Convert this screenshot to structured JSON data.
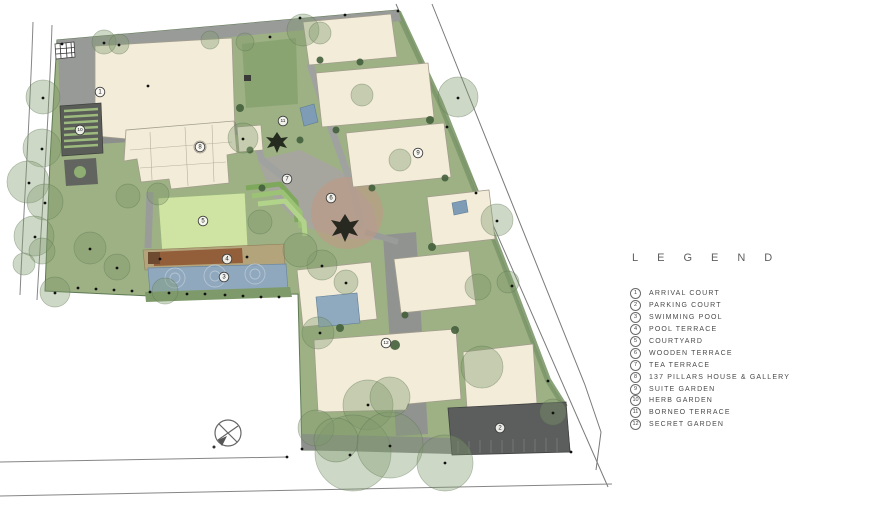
{
  "legend": {
    "title": "LEGEND",
    "items": [
      {
        "number": "1",
        "label": "ARRIVAL COURT"
      },
      {
        "number": "2",
        "label": "PARKING COURT"
      },
      {
        "number": "3",
        "label": "SWIMMING POOL"
      },
      {
        "number": "4",
        "label": "POOL TERRACE"
      },
      {
        "number": "5",
        "label": "COURTYARD"
      },
      {
        "number": "6",
        "label": "WOODEN TERRACE"
      },
      {
        "number": "7",
        "label": "TEA TERRACE"
      },
      {
        "number": "8",
        "label": "137 PILLARS HOUSE & GALLERY"
      },
      {
        "number": "9",
        "label": "SUITE GARDEN"
      },
      {
        "number": "10",
        "label": "HERB GARDEN"
      },
      {
        "number": "11",
        "label": "BORNEO TERRACE"
      },
      {
        "number": "12",
        "label": "SECRET GARDEN"
      }
    ]
  },
  "plan": {
    "colors": {
      "site_green": "#9db184",
      "building_cream": "#f2ecd9",
      "paving_gray": "#a0a2a0",
      "pool_blue": "#8fa8bd",
      "deck_brown": "#935f3b",
      "courtyard_green": "#cfe3a2",
      "parking_dark": "#5c5e5d",
      "salmon_lawn": "#c09a83"
    },
    "markers": [
      {
        "n": "1",
        "x": 100,
        "y": 92
      },
      {
        "n": "2",
        "x": 500,
        "y": 428
      },
      {
        "n": "3",
        "x": 224,
        "y": 277
      },
      {
        "n": "4",
        "x": 227,
        "y": 259
      },
      {
        "n": "5",
        "x": 203,
        "y": 221
      },
      {
        "n": "6",
        "x": 331,
        "y": 198
      },
      {
        "n": "7",
        "x": 287,
        "y": 179
      },
      {
        "n": "8",
        "x": 200,
        "y": 147
      },
      {
        "n": "9",
        "x": 418,
        "y": 153
      },
      {
        "n": "10",
        "x": 80,
        "y": 130
      },
      {
        "n": "11",
        "x": 283,
        "y": 121
      },
      {
        "n": "12",
        "x": 386,
        "y": 343
      }
    ],
    "trees": [
      [
        43,
        97,
        17
      ],
      [
        42,
        148,
        19
      ],
      [
        28,
        182,
        21
      ],
      [
        45,
        202,
        18
      ],
      [
        34,
        236,
        20
      ],
      [
        42,
        251,
        13
      ],
      [
        55,
        292,
        15
      ],
      [
        24,
        264,
        11
      ],
      [
        104,
        42,
        12
      ],
      [
        119,
        44,
        10
      ],
      [
        90,
        248,
        16
      ],
      [
        117,
        267,
        13
      ],
      [
        165,
        291,
        13
      ],
      [
        303,
        30,
        16
      ],
      [
        320,
        33,
        11
      ],
      [
        243,
        138,
        15
      ],
      [
        210,
        40,
        9
      ],
      [
        245,
        42,
        9
      ],
      [
        458,
        97,
        20
      ],
      [
        497,
        220,
        16
      ],
      [
        508,
        282,
        11
      ],
      [
        553,
        412,
        13
      ],
      [
        478,
        287,
        13
      ],
      [
        482,
        367,
        21
      ],
      [
        322,
        265,
        15
      ],
      [
        346,
        282,
        12
      ],
      [
        318,
        333,
        16
      ],
      [
        368,
        405,
        25
      ],
      [
        353,
        453,
        38
      ],
      [
        390,
        445,
        33
      ],
      [
        445,
        463,
        28
      ],
      [
        390,
        397,
        20
      ],
      [
        316,
        428,
        18
      ],
      [
        336,
        440,
        22
      ],
      [
        300,
        250,
        17
      ],
      [
        260,
        222,
        12
      ],
      [
        128,
        196,
        12
      ],
      [
        158,
        194,
        11
      ],
      [
        362,
        95,
        11
      ],
      [
        400,
        160,
        11
      ]
    ],
    "dots": [
      [
        62,
        44
      ],
      [
        300,
        18
      ],
      [
        345,
        15
      ],
      [
        270,
        37
      ],
      [
        398,
        11
      ],
      [
        447,
        127
      ],
      [
        476,
        193
      ],
      [
        512,
        286
      ],
      [
        548,
        381
      ],
      [
        287,
        457
      ],
      [
        302,
        449
      ],
      [
        571,
        452
      ],
      [
        160,
        259
      ],
      [
        247,
        257
      ],
      [
        225,
        295
      ],
      [
        243,
        296
      ],
      [
        261,
        297
      ],
      [
        279,
        297
      ],
      [
        205,
        294
      ],
      [
        187,
        294
      ],
      [
        169,
        293
      ],
      [
        150,
        292
      ],
      [
        132,
        291
      ],
      [
        114,
        290
      ],
      [
        96,
        289
      ],
      [
        78,
        288
      ],
      [
        350,
        455
      ],
      [
        390,
        446
      ],
      [
        445,
        463
      ],
      [
        368,
        405
      ],
      [
        320,
        333
      ],
      [
        497,
        221
      ],
      [
        458,
        98
      ],
      [
        553,
        413
      ],
      [
        322,
        266
      ],
      [
        346,
        283
      ],
      [
        243,
        139
      ],
      [
        104,
        43
      ],
      [
        119,
        45
      ],
      [
        43,
        98
      ],
      [
        42,
        149
      ],
      [
        29,
        183
      ],
      [
        45,
        203
      ],
      [
        35,
        237
      ],
      [
        55,
        293
      ],
      [
        90,
        249
      ],
      [
        117,
        268
      ],
      [
        148,
        86
      ]
    ]
  }
}
